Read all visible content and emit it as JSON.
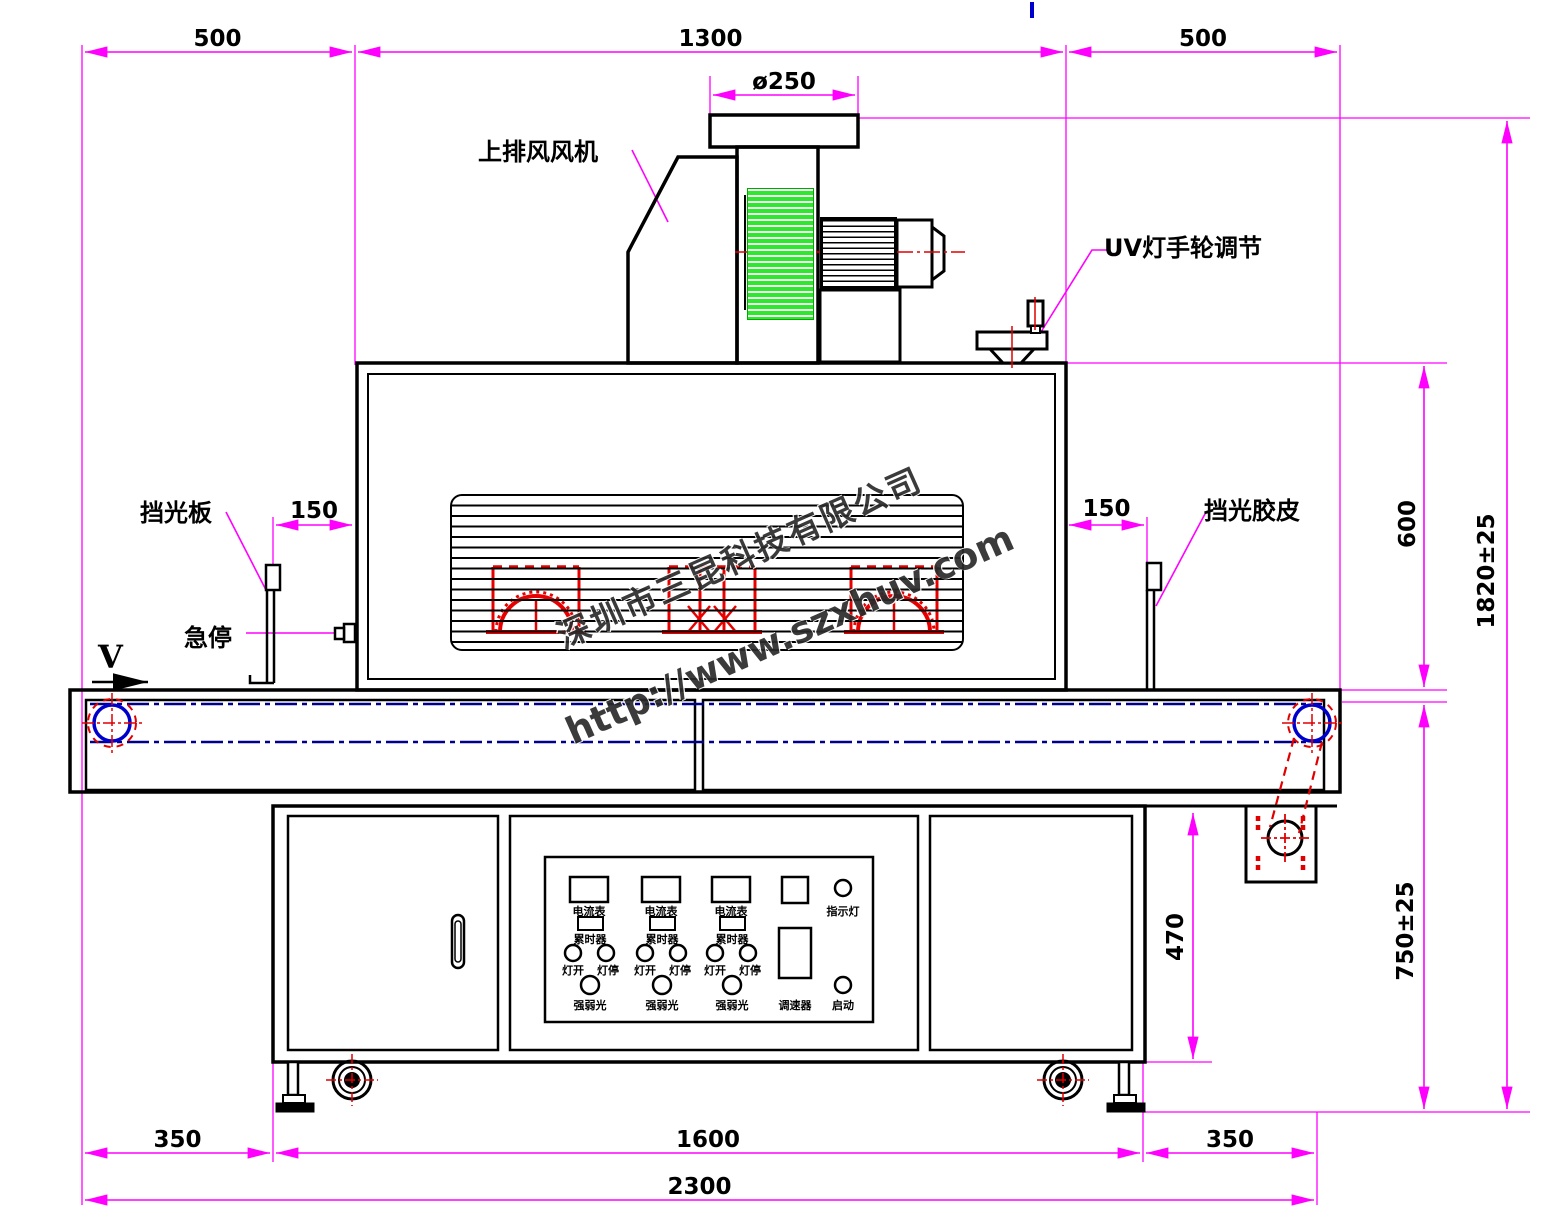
{
  "drawing": {
    "title_note": "UV curing machine front-view CAD drawing",
    "dimensions": {
      "top_left": "500",
      "top_center": "1300",
      "top_right": "500",
      "flange_diameter": "ø250",
      "left_gap": "150",
      "right_gap": "150",
      "oven_height": "600",
      "total_height": "1820±25",
      "cabinet_height": "470",
      "belt_height": "750±25",
      "bottom_left": "350",
      "bottom_center": "1600",
      "bottom_right": "350",
      "total_length": "2300",
      "belt_direction": "V"
    },
    "labels": {
      "top_exhaust_fan": "上排风风机",
      "uv_lamp_handwheel": "UV灯手轮调节",
      "light_shield_plate": "挡光板",
      "emergency_stop": "急停",
      "light_shield_rubber": "挡光胶皮"
    },
    "control_panel": {
      "ammeter_label": "电流表",
      "hour_meter_label": "累时器",
      "lamp_on_label": "灯开",
      "lamp_off_label": "灯停",
      "light_intensity_label": "强弱光",
      "speed_controller_label": "调速器",
      "indicator_lamp_label": "指示灯",
      "start_label": "启动"
    },
    "watermark": {
      "company": "深圳市三昆科技有限公司",
      "url": "http://www.szxhuv.com"
    },
    "colors": {
      "dimension_lines": "#ff00ff",
      "uv_lamp_symbols": "#e80000",
      "belt_centerline": "#00008b",
      "roller": "#0000cc",
      "fan_fins_fill": "#2de82d",
      "outline": "#000000"
    }
  }
}
